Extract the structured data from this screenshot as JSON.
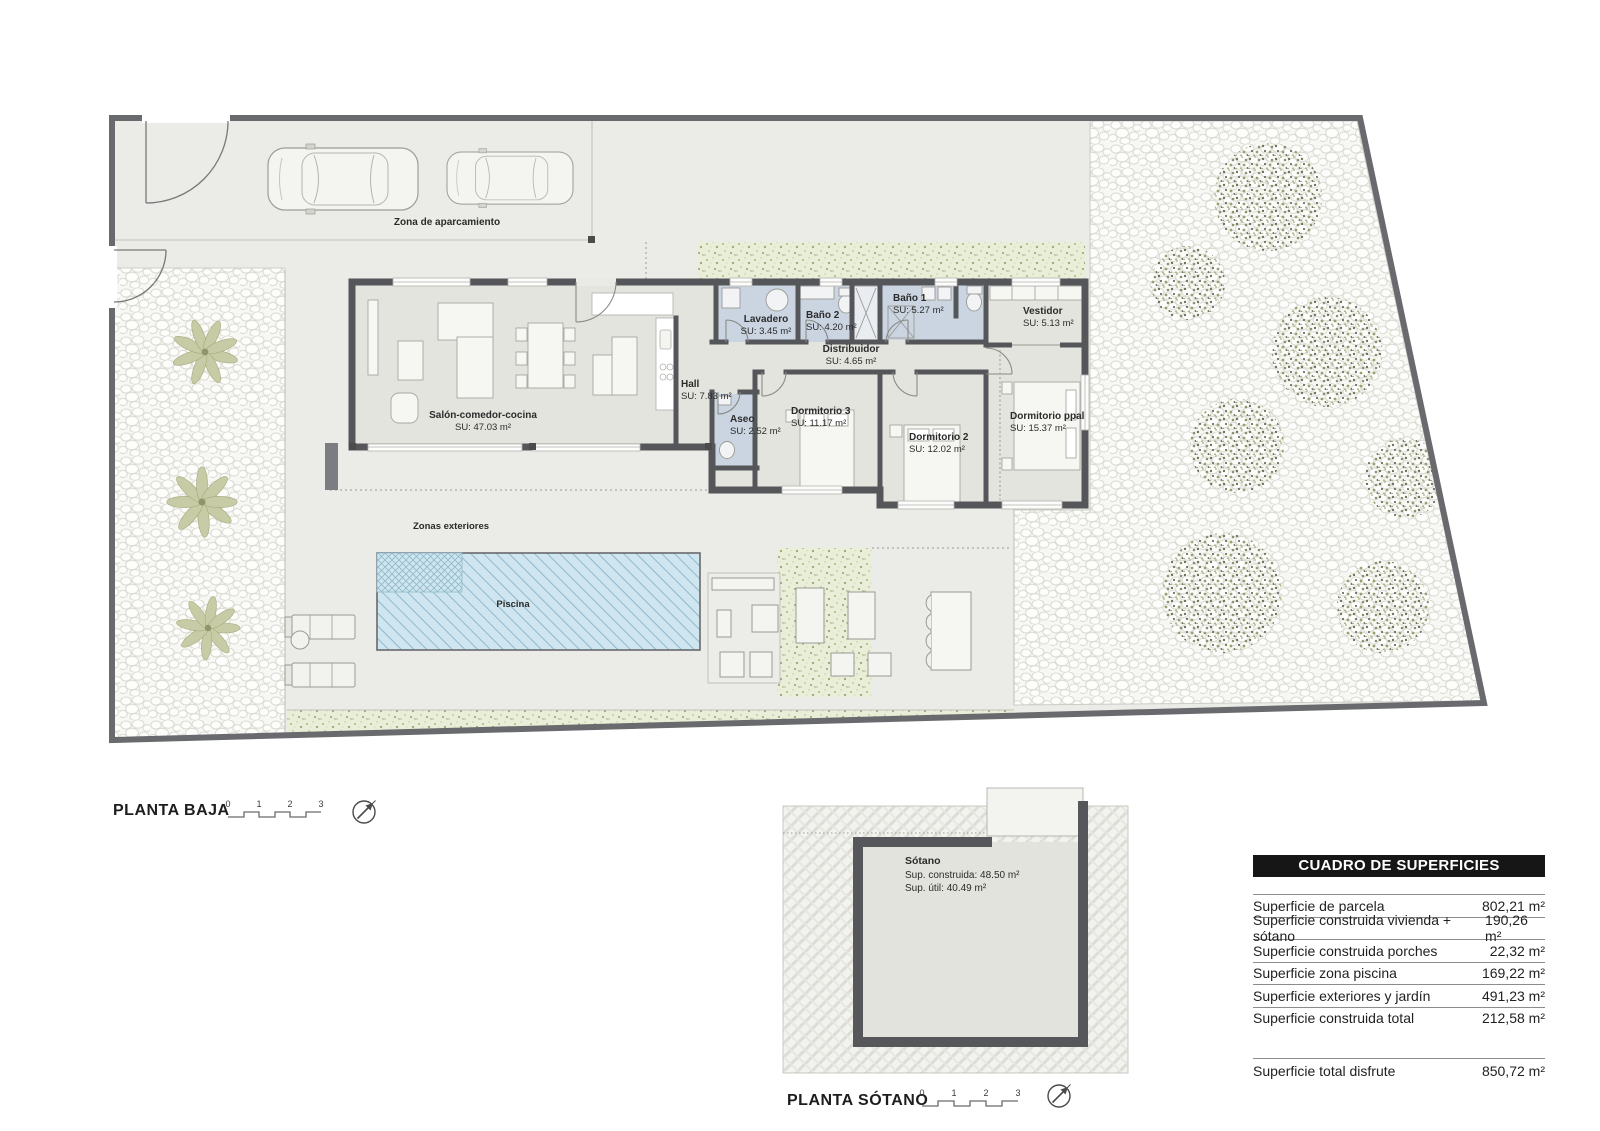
{
  "ground_floor": {
    "title": "PLANTA BAJA",
    "parking_label": "Zona de aparcamiento",
    "exteriors_label": "Zonas exteriores",
    "pool_label": "Piscina",
    "rooms": [
      {
        "name": "Salón-comedor-cocina",
        "area": "SU: 47.03 m²"
      },
      {
        "name": "Hall",
        "area": "SU: 7.83 m²"
      },
      {
        "name": "Lavadero",
        "area": "SU: 3.45 m²"
      },
      {
        "name": "Baño 2",
        "area": "SU: 4.20 m²"
      },
      {
        "name": "Baño 1",
        "area": "SU: 5.27 m²"
      },
      {
        "name": "Distribuidor",
        "area": "SU: 4.65 m²"
      },
      {
        "name": "Vestidor",
        "area": "SU: 5.13 m²"
      },
      {
        "name": "Aseo",
        "area": "SU: 2.52 m²"
      },
      {
        "name": "Dormitorio 3",
        "area": "SU: 11.17 m²"
      },
      {
        "name": "Dormitorio 2",
        "area": "SU: 12.02 m²"
      },
      {
        "name": "Dormitorio ppal",
        "area": "SU: 15.37 m²"
      }
    ],
    "scale_ticks": [
      "0",
      "1",
      "2",
      "3"
    ]
  },
  "basement": {
    "title": "PLANTA SÓTANO",
    "room_name": "Sótano",
    "built_area": "Sup. construida: 48.50 m²",
    "usable_area": "Sup. útil: 40.49 m²",
    "scale_ticks": [
      "0",
      "1",
      "2",
      "3"
    ]
  },
  "surface_table": {
    "title": "CUADRO DE SUPERFICIES",
    "rows": [
      {
        "label": "Superficie de parcela",
        "value": "802,21 m²"
      },
      {
        "label": "Superficie construida vivienda + sótano",
        "value": "190,26 m²"
      },
      {
        "label": "Superficie construida porches",
        "value": "22,32 m²"
      },
      {
        "label": "Superficie zona piscina",
        "value": "169,22 m²"
      },
      {
        "label": "Superficie exteriores y jardín",
        "value": "491,23 m²"
      },
      {
        "label": "Superficie construida total",
        "value": "212,58 m²"
      }
    ],
    "total_row": {
      "label": "Superficie total disfrute",
      "value": "850,72 m²"
    }
  },
  "colors": {
    "wall": "#55565a",
    "interior_floor": "#e4e4de",
    "wet_room": "#cbd5e2",
    "pool_water": "#cfe5ef",
    "ground": "#ebebe7",
    "vegetation": "#a9b681",
    "table_header_bg": "#161616"
  }
}
